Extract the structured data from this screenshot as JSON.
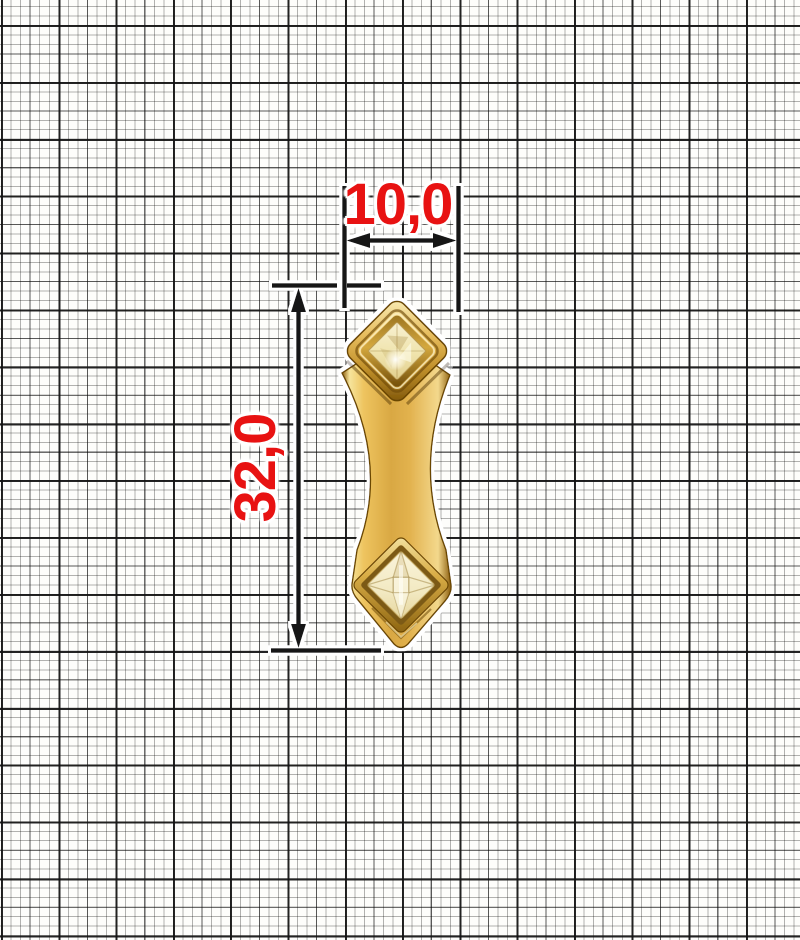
{
  "annotations": {
    "width_label": "10,0",
    "height_label": "32,0",
    "label_color": "#e81212",
    "line_color": "#141414",
    "halo_color": "#ffffff"
  },
  "grid": {
    "style": "graph-paper",
    "minor_cell_px": 9.5,
    "major_cell_px": 57,
    "minor_line_color": "rgba(0,0,0,0.30)",
    "medium_line_color": "rgba(0,0,0,0.50)",
    "major_line_color": "#121212",
    "background_color": "#fdfdfb"
  },
  "object": {
    "type": "gold-accessory-fitting",
    "description": "gold fitting with two diamond-set square crystals joined by a concave waisted bar",
    "colors": {
      "gold_highlight": "#f9edb8",
      "gold_mid": "#dcae4c",
      "gold_dark": "#7c5408",
      "crystal_top": "#efe3ac",
      "crystal_bottom": "#f2e9c2"
    }
  }
}
